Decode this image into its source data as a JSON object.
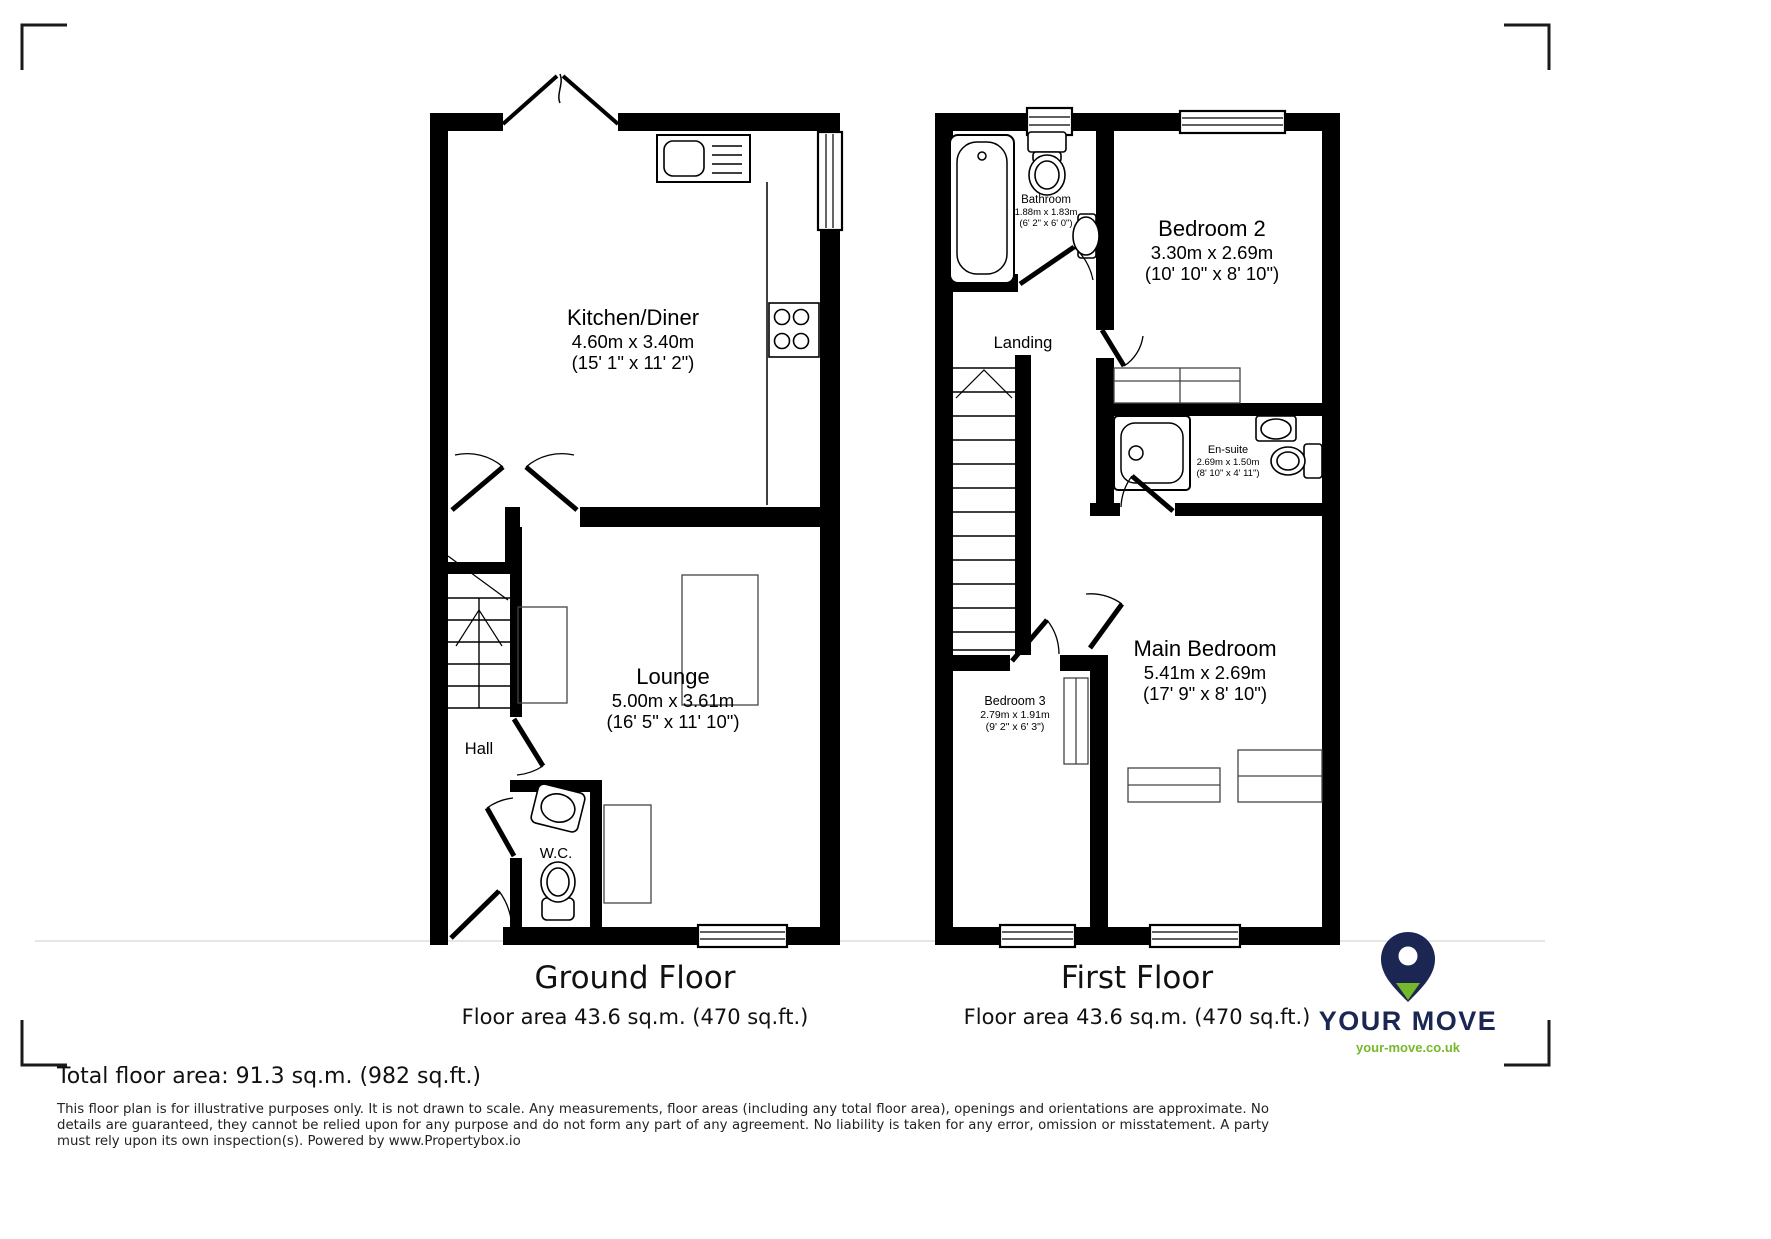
{
  "ground_floor": {
    "title": "Ground Floor",
    "floor_area": "Floor area 43.6 sq.m. (470 sq.ft.)",
    "rooms": {
      "kitchen": {
        "name": "Kitchen/Diner",
        "metric": "4.60m x 3.40m",
        "imperial": "(15' 1\" x 11' 2\")"
      },
      "lounge": {
        "name": "Lounge",
        "metric": "5.00m x 3.61m",
        "imperial": "(16' 5\" x 11' 10\")"
      },
      "hall": {
        "name": "Hall"
      },
      "wc": {
        "name": "W.C."
      }
    }
  },
  "first_floor": {
    "title": "First Floor",
    "floor_area": "Floor area 43.6 sq.m. (470 sq.ft.)",
    "rooms": {
      "bathroom": {
        "name": "Bathroom",
        "metric": "1.88m x 1.83m",
        "imperial": "(6' 2\" x 6' 0\")"
      },
      "bedroom2": {
        "name": "Bedroom 2",
        "metric": "3.30m x 2.69m",
        "imperial": "(10' 10\" x 8' 10\")"
      },
      "landing": {
        "name": "Landing"
      },
      "ensuite": {
        "name": "En-suite",
        "metric": "2.69m x 1.50m",
        "imperial": "(8' 10\" x 4' 11\")"
      },
      "bedroom3": {
        "name": "Bedroom 3",
        "metric": "2.79m x 1.91m",
        "imperial": "(9' 2\" x 6' 3\")"
      },
      "main_bedroom": {
        "name": "Main Bedroom",
        "metric": "5.41m x 2.69m",
        "imperial": "(17' 9\" x 8' 10\")"
      }
    }
  },
  "footer": {
    "total_area": "Total floor area: 91.3 sq.m. (982 sq.ft.)",
    "disclaimer": "This floor plan is for illustrative purposes only. It is not drawn to scale. Any measurements, floor areas (including any total floor area), openings and orientations are approximate. No details are guaranteed, they cannot be relied upon for any purpose and do not form any part of any agreement. No liability is taken for any error, omission or misstatement. A party must rely upon its own inspection(s). Powered by www.Propertybox.io"
  },
  "branding": {
    "logo_text": "YOUR MOVE",
    "logo_url": "your-move.co.uk",
    "navy": "#1b2653",
    "green": "#76b82a"
  }
}
